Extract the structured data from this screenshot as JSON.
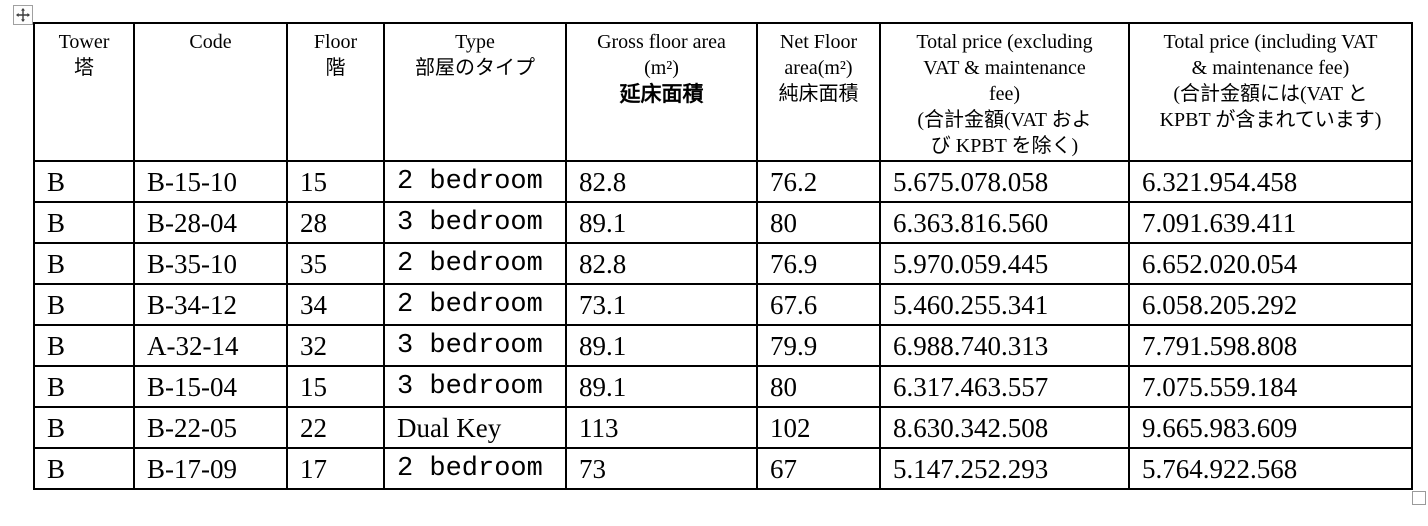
{
  "handles": {
    "move_handle_icon": "move-cross-icon",
    "resize_handle_icon": "resize-square-icon"
  },
  "table": {
    "headers": [
      {
        "id": "tower",
        "lines": [
          {
            "t": "Tower"
          },
          {
            "t": "塔"
          }
        ]
      },
      {
        "id": "code",
        "lines": [
          {
            "t": "Code"
          }
        ]
      },
      {
        "id": "floor",
        "lines": [
          {
            "t": "Floor"
          },
          {
            "t": "階"
          }
        ]
      },
      {
        "id": "type",
        "lines": [
          {
            "t": "Type"
          },
          {
            "t": "部屋のタイプ"
          }
        ]
      },
      {
        "id": "gross-area",
        "lines": [
          {
            "t": "Gross floor area"
          },
          {
            "t": "(m²)"
          },
          {
            "t": "延床面積",
            "style": "cjk-bold"
          }
        ]
      },
      {
        "id": "net-area",
        "lines": [
          {
            "t": "Net Floor"
          },
          {
            "t": "area(m²)"
          },
          {
            "t": "純床面積"
          }
        ]
      },
      {
        "id": "price-excl",
        "lines": [
          {
            "t": "Total price (excluding"
          },
          {
            "t": "VAT & maintenance"
          },
          {
            "t": "fee)"
          },
          {
            "t": "(合計金額(VAT およ"
          },
          {
            "t": "び KPBT を除く)"
          }
        ]
      },
      {
        "id": "price-incl",
        "lines": [
          {
            "t": "Total price (including VAT"
          },
          {
            "t": "& maintenance fee)"
          },
          {
            "t": "(合計金額には(VAT と"
          },
          {
            "t": "KPBT が含まれています)"
          }
        ]
      }
    ],
    "rows": [
      {
        "tower": "B",
        "code": "B-15-10",
        "floor": "15",
        "type": "2 bedroom",
        "type_mono": true,
        "gross": "82.8",
        "net": "76.2",
        "price_excl": "5.675.078.058",
        "price_incl": "6.321.954.458"
      },
      {
        "tower": "B",
        "code": "B-28-04",
        "floor": "28",
        "type": "3 bedroom",
        "type_mono": true,
        "gross": "89.1",
        "net": "80",
        "price_excl": "6.363.816.560",
        "price_incl": "7.091.639.411"
      },
      {
        "tower": "B",
        "code": "B-35-10",
        "floor": "35",
        "type": "2 bedroom",
        "type_mono": true,
        "gross": "82.8",
        "net": "76.9",
        "price_excl": "5.970.059.445",
        "price_incl": "6.652.020.054"
      },
      {
        "tower": "B",
        "code": "B-34-12",
        "floor": "34",
        "type": "2 bedroom",
        "type_mono": true,
        "gross": "73.1",
        "net": "67.6",
        "price_excl": "5.460.255.341",
        "price_incl": "6.058.205.292"
      },
      {
        "tower": "B",
        "code": "A-32-14",
        "floor": "32",
        "type": "3 bedroom",
        "type_mono": true,
        "gross": "89.1",
        "net": "79.9",
        "price_excl": "6.988.740.313",
        "price_incl": "7.791.598.808"
      },
      {
        "tower": "B",
        "code": "B-15-04",
        "floor": "15",
        "type": "3 bedroom",
        "type_mono": true,
        "gross": "89.1",
        "net": "80",
        "price_excl": "6.317.463.557",
        "price_incl": "7.075.559.184"
      },
      {
        "tower": "B",
        "code": "B-22-05",
        "floor": "22",
        "type": "Dual Key",
        "type_mono": false,
        "gross": "113",
        "net": "102",
        "price_excl": "8.630.342.508",
        "price_incl": "9.665.983.609"
      },
      {
        "tower": "B",
        "code": "B-17-09",
        "floor": "17",
        "type": "2 bedroom",
        "type_mono": true,
        "gross": "73",
        "net": "67",
        "price_excl": "5.147.252.293",
        "price_incl": "5.764.922.568"
      }
    ],
    "column_order": [
      "tower",
      "code",
      "floor",
      "type",
      "gross",
      "net",
      "price_excl",
      "price_incl"
    ],
    "column_widths_px": [
      100,
      153,
      97,
      182,
      191,
      123,
      249,
      283
    ],
    "colors": {
      "border": "#000000",
      "text": "#000000",
      "background": "#ffffff",
      "handle_border": "#9a9a9a"
    }
  }
}
